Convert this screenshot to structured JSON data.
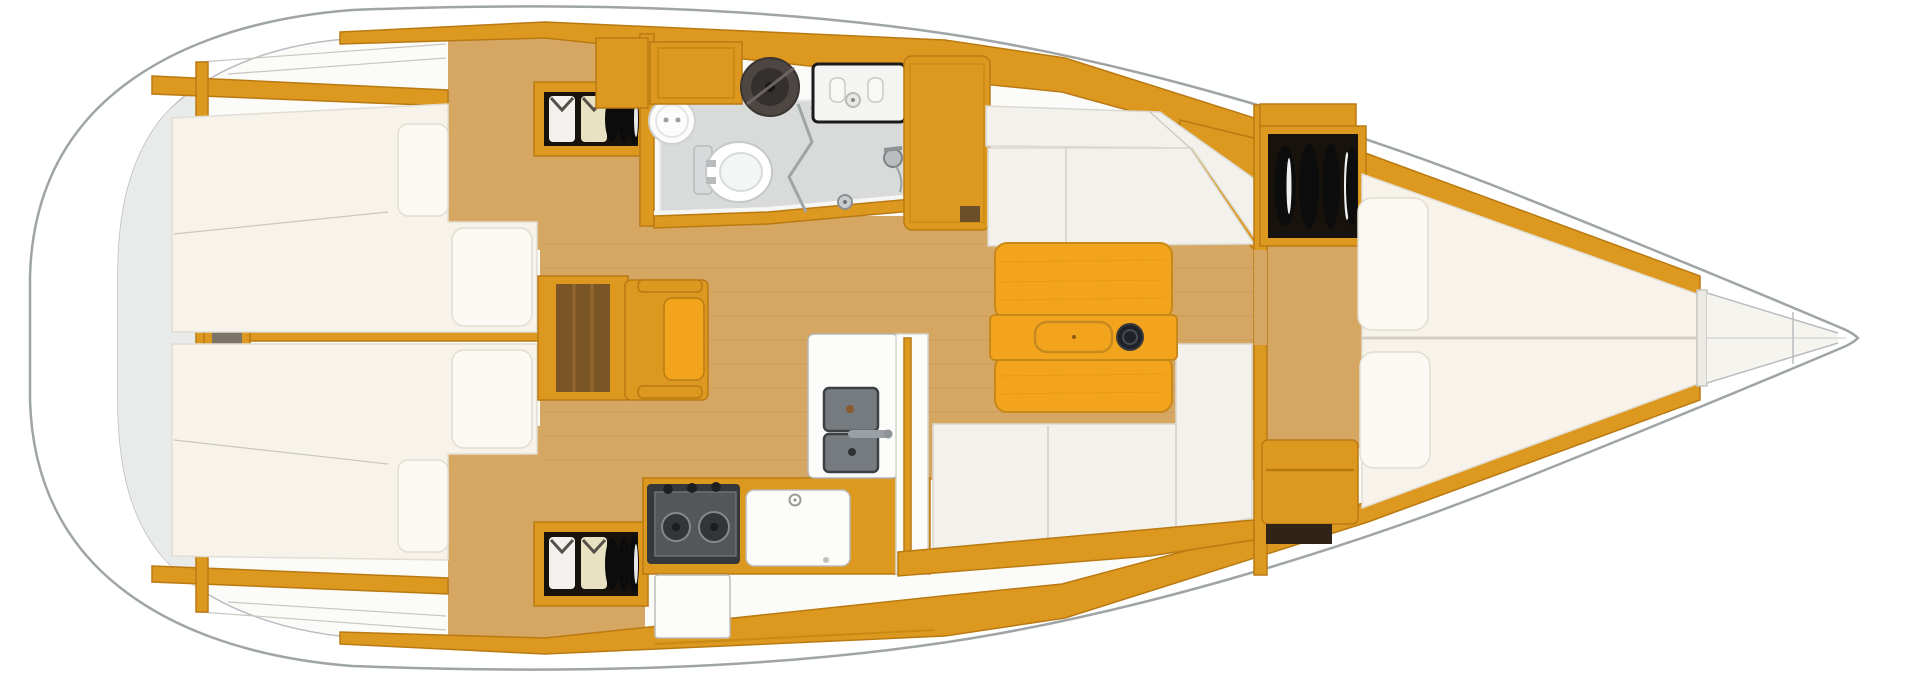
{
  "page": {
    "kind": "yacht-interior-floorplan",
    "view": "top-down plan, bow pointing right, no visible text"
  },
  "palette": {
    "hull_stroke": "#9fa4a6",
    "deck": "#ffffff",
    "interior": "#fbfbfa",
    "stern_shade": "#e9eaea",
    "wood": "#dd9820",
    "wood_bright": "#f2a41c",
    "wood_dark": "#b97a12",
    "wood_brown": "#7a5526",
    "floor": "#d6a763",
    "mattress": "#f7f3eb",
    "mattress_stroke": "#e2ddd2",
    "pillow": "#fbf9f4",
    "settee": "#f2f1eb",
    "head_floor": "#d9dbdb",
    "fixture": "#fcfcfb",
    "stove_body": "#36383a",
    "stove_panel": "#54565a",
    "sink_basin": "#767b7f",
    "locker_interior": "#17120c",
    "shirt_white": "#f2f1ee",
    "shirt_cream": "#e9e2c2",
    "locker_disc": "#0c0c0c",
    "table_cup": "#20222a"
  },
  "features": {
    "aft_cabins": [
      "double-berth",
      "pillows",
      "hanging-locker-with-clothes",
      "cabin-sole",
      "stern-niche"
    ],
    "companionway": [
      "companionway-steps",
      "engine-box",
      "grab-rails"
    ],
    "head": [
      "toilet",
      "round-washbasin",
      "shower-drain",
      "folding-shower-screen",
      "shower-mixer",
      "sink-unit",
      "storage-cabinets"
    ],
    "galley": [
      "two-burner-stove",
      "oven-door",
      "fridge-top-lid",
      "double-sink",
      "faucet",
      "counter",
      "grab-rail"
    ],
    "saloon": [
      "starboard-settee",
      "port-l-settee",
      "folding-table",
      "table-tray",
      "cup-holder"
    ],
    "forward_cabin": [
      "v-berth",
      "pillows",
      "locker-with-folded-clothes",
      "step-seat",
      "anchor-locker"
    ]
  }
}
